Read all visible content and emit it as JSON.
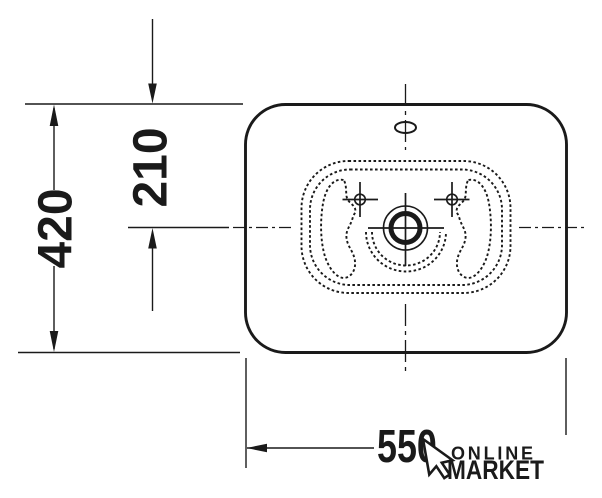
{
  "page": {
    "background": "#ffffff",
    "ink_color": "#1a1a1a"
  },
  "drawing": {
    "dimensions": {
      "height": "420",
      "half_height": "210",
      "width": "550"
    },
    "watermark": {
      "line1": "ONLINE",
      "line2": "MARKET",
      "icon": "cursor-arrow-icon"
    }
  }
}
